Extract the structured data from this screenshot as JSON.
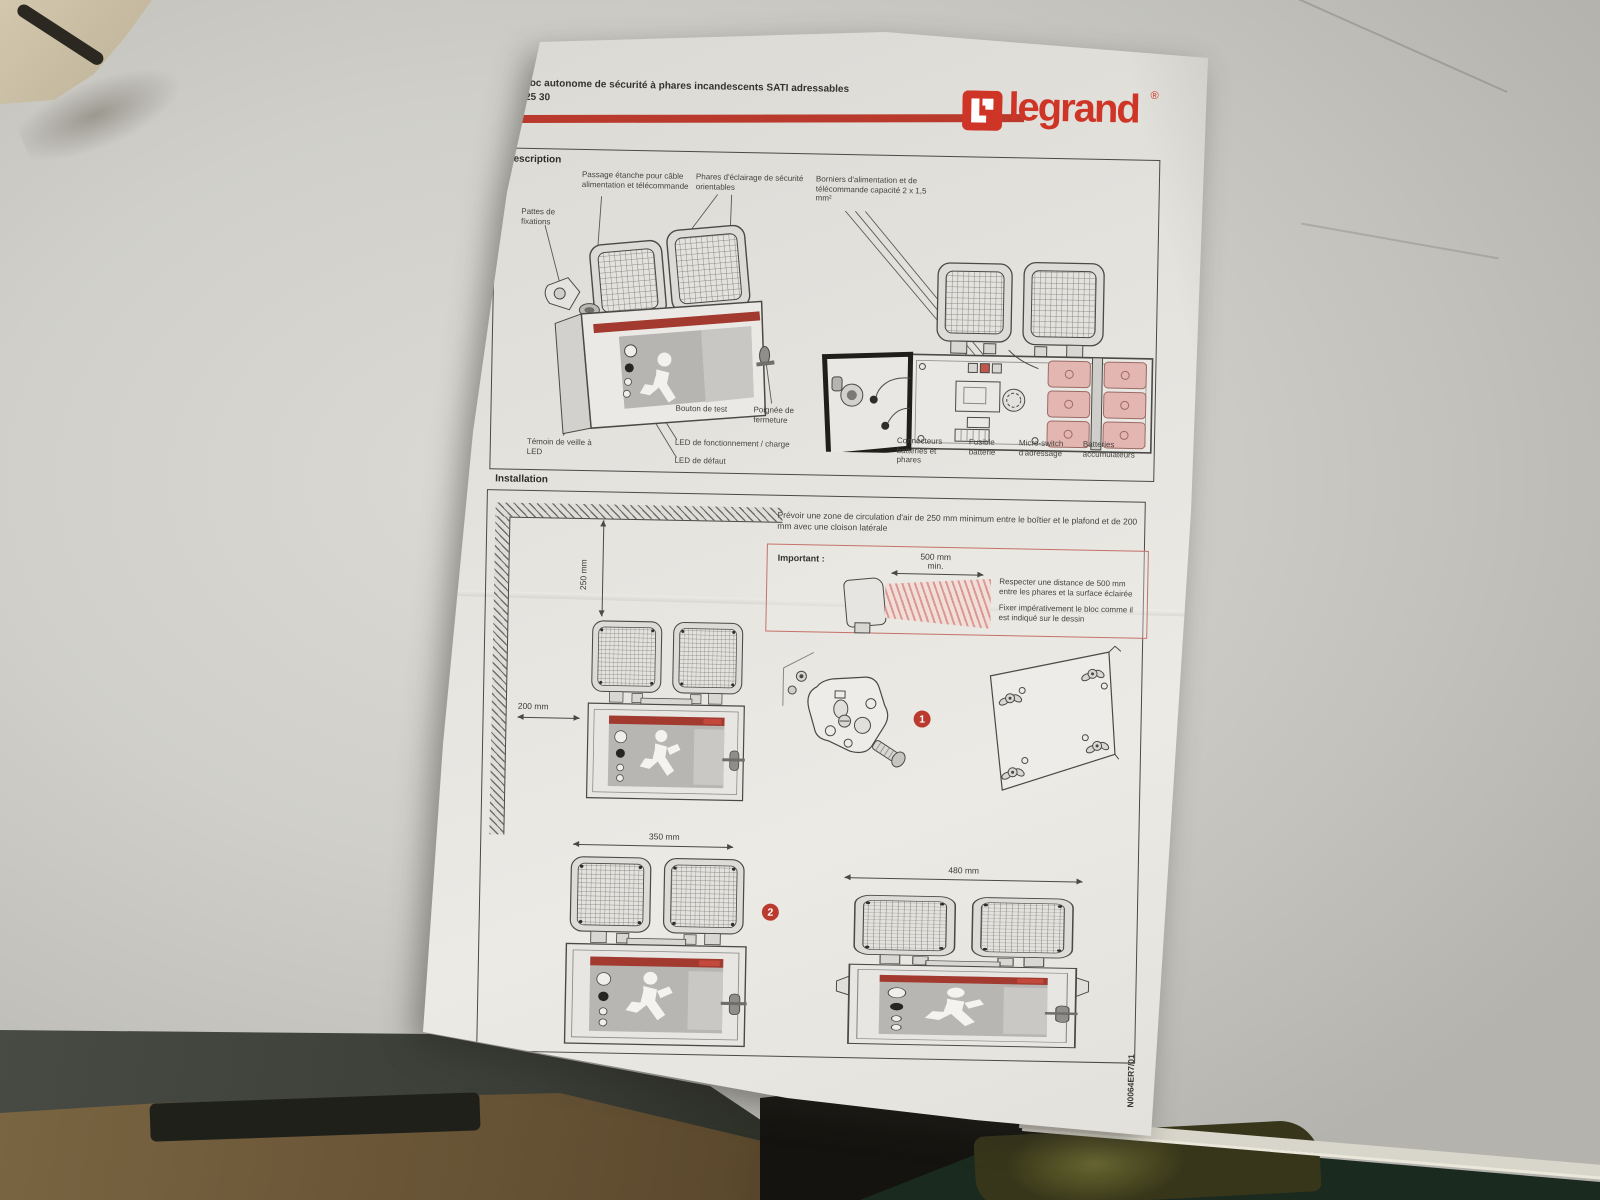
{
  "sheet": {
    "header": {
      "title": "Bloc autonome de sécurité à phares incandescents SATI adressables",
      "reference": "625 30",
      "logo_text": "legrand",
      "logo_registered": "®"
    },
    "description": {
      "title": "Description",
      "labels": {
        "passage": "Passage étanche pour câble alimentation et télécommande",
        "phares": "Phares d'éclairage de sécurité orientables",
        "borniers": "Borniers d'alimentation et de télécommande capacité 2 x 1,5 mm²",
        "pattes": "Pattes de fixations",
        "bouton_test": "Bouton de test",
        "poignee": "Poignée de fermeture",
        "led_fonctionnement": "LED de fonctionnement / charge",
        "temoin": "Témoin de veille à LED",
        "led_defaut": "LED de défaut",
        "connecteurs": "Connecteurs batteries et phares",
        "fusible": "Fusible batterie",
        "micro_switch": "Micro-switch d'adressage",
        "batteries": "Batteries accumulateurs"
      }
    },
    "installation": {
      "title": "Installation",
      "intro": "Prévoir une zone de circulation d'air de 250 mm minimum entre le boîtier et le plafond et de 200 mm avec une cloison latérale",
      "important_label": "Important :",
      "clearance_500": "500 mm",
      "clearance_500_min": "min.",
      "note_distance": "Respecter une distance de 500 mm entre les phares et la surface éclairée",
      "note_fixing": "Fixer impérativement le bloc comme il est indiqué sur le dessin",
      "dim_top": "250 mm",
      "dim_side": "200 mm",
      "dim_width_350": "350 mm",
      "dim_width_480": "480 mm",
      "step_1": "1",
      "step_2": "2"
    },
    "footer": {
      "doc_ref": "N0064ER7/01"
    }
  },
  "colors": {
    "brand_red": "#cf3527",
    "header_bar_red": "#b93a2c",
    "panel_strip_red": "#a23a30",
    "battery_pink": "#e3b6b1",
    "paper": "#e4e2dd",
    "desk": "#cccbc6"
  }
}
